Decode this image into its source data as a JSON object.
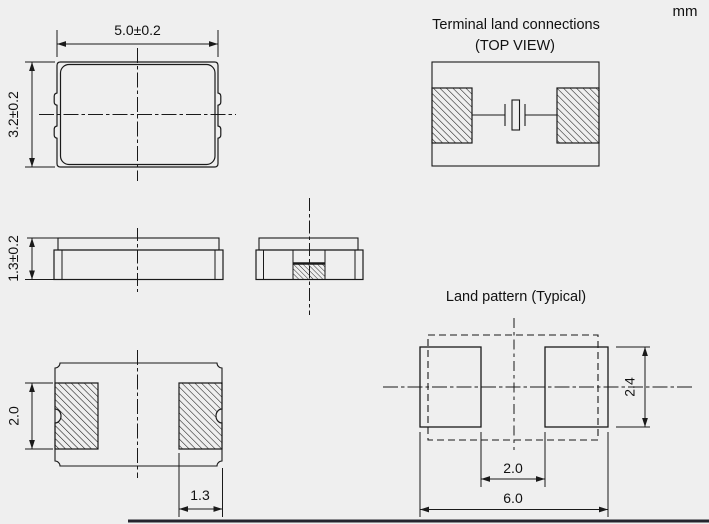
{
  "unit_label": "mm",
  "top_view": {
    "dim_width": "5.0±0.2",
    "dim_height": "3.2±0.2"
  },
  "side_view": {
    "dim_height": "1.3±0.2"
  },
  "bottom_view": {
    "dim_pad_height": "2.0",
    "dim_pad_width": "1.3"
  },
  "terminal_view": {
    "title_line1": "Terminal land connections",
    "title_line2": "(TOP VIEW)"
  },
  "land_pattern": {
    "title": "Land pattern (Typical)",
    "dim_pad_gap": "2.0",
    "dim_overall_width": "6.0",
    "dim_pad_height": "2.4"
  },
  "colors": {
    "line": "#1a1a1a",
    "background": "#efefef",
    "text": "#111111"
  }
}
